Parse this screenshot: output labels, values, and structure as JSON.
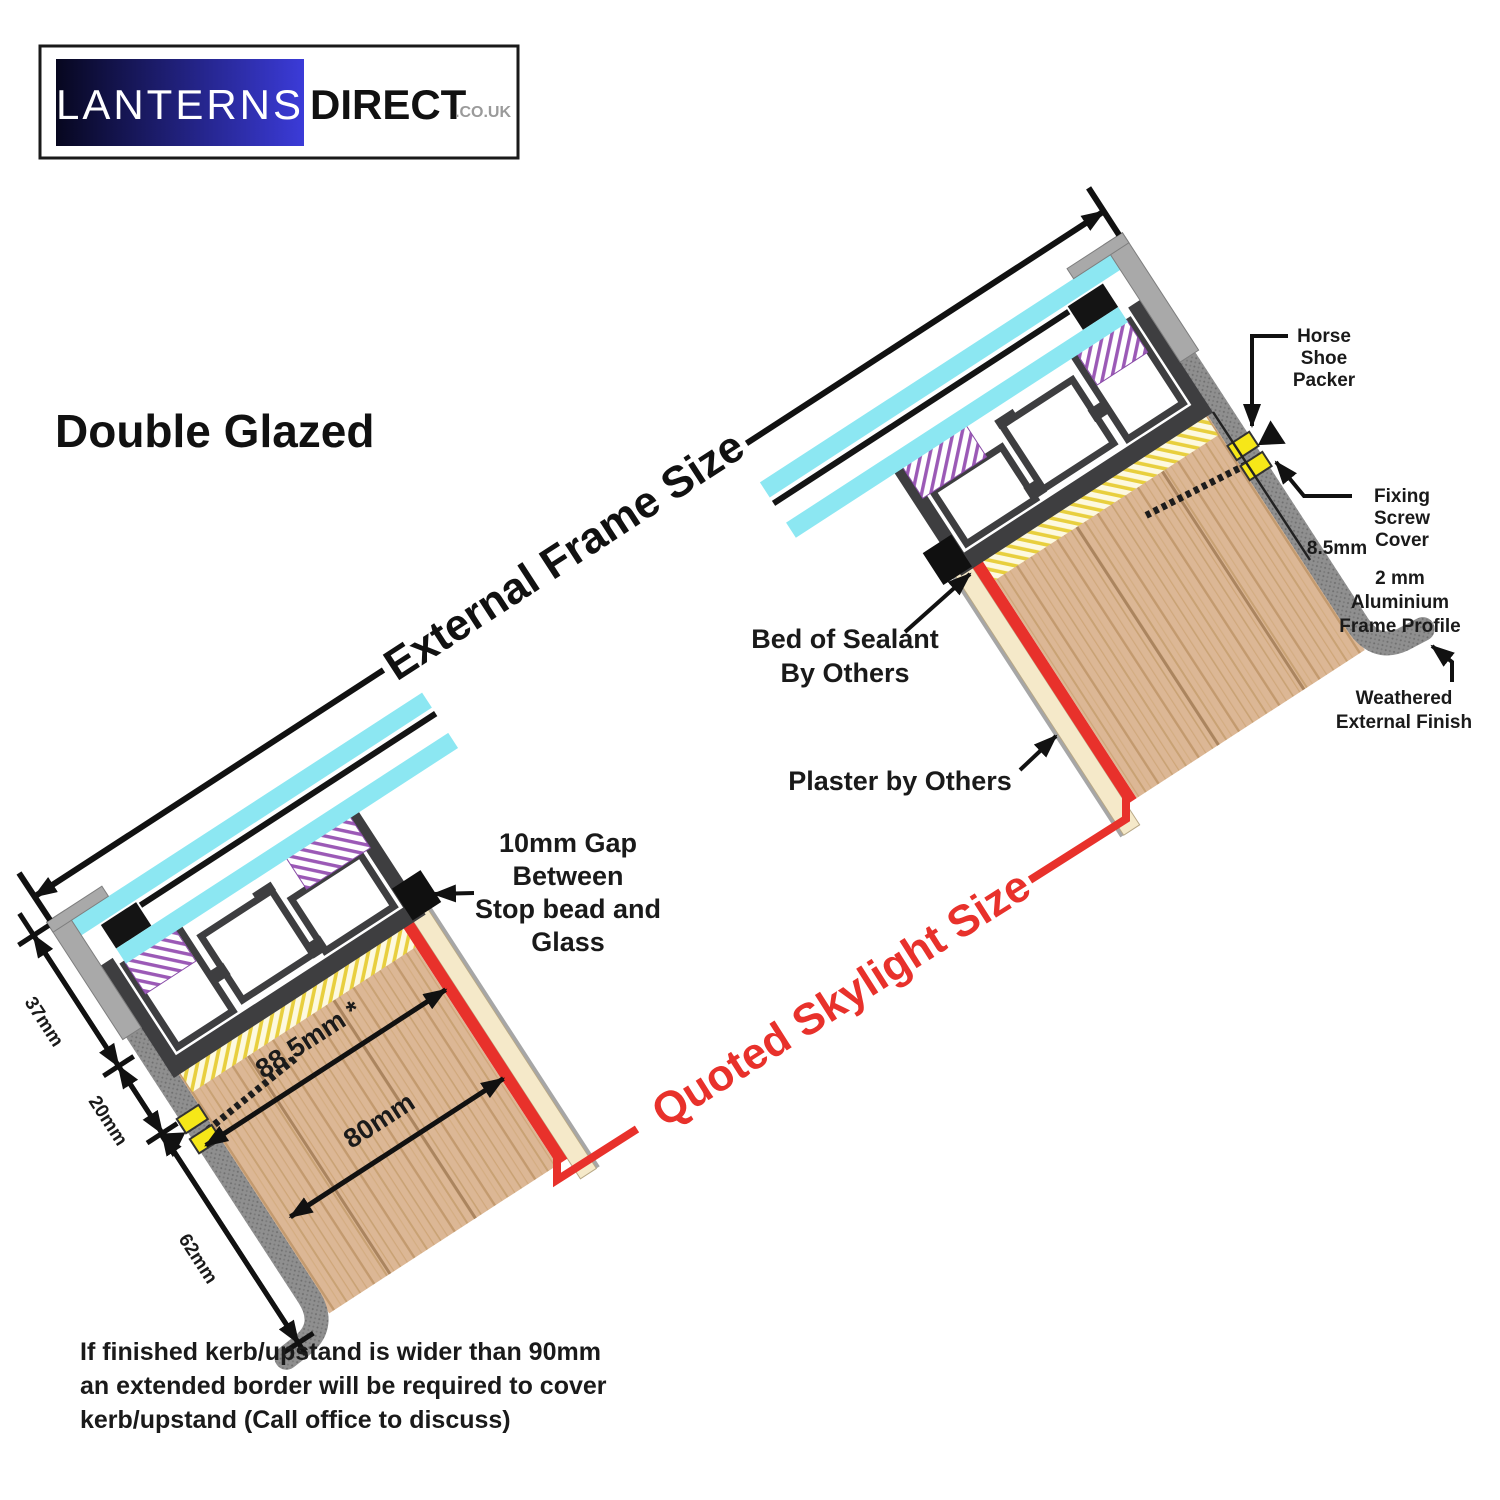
{
  "logo": {
    "brand_primary": "LANTERNS",
    "brand_secondary": "DIRECT",
    "brand_tld": ".CO.UK"
  },
  "heading": {
    "title": "Double Glazed"
  },
  "dimensions": {
    "external_frame": "External Frame Size",
    "quoted_skylight": "Quoted Skylight Size",
    "depth_37": "37mm",
    "depth_20": "20mm",
    "depth_62": "62mm",
    "kerb_top_width": "88.5mm *",
    "kerb_width": "80mm",
    "profile_gap": "8.5mm"
  },
  "callouts": {
    "horse_shoe_packer": [
      "Horse",
      "Shoe",
      "Packer"
    ],
    "fixing_screw_cover": [
      "Fixing",
      "Screw",
      "Cover"
    ],
    "aluminium_profile": [
      "2 mm",
      "Aluminium",
      "Frame Profile"
    ],
    "weathered_finish": [
      "Weathered",
      "External Finish"
    ],
    "bed_of_sealant": [
      "Bed of Sealant",
      "By Others"
    ],
    "plaster": "Plaster by Others",
    "gap_10mm": [
      "10mm Gap",
      "Between",
      "Stop bead and",
      "Glass"
    ]
  },
  "footnote": {
    "lines": [
      "If finished kerb/upstand is wider than 90mm",
      "an extended border will be required to cover",
      "kerb/upstand (Call office to discuss)"
    ]
  },
  "colors": {
    "accent_red": "#e8312b",
    "glass_cyan": "#8ce7f2",
    "wood_tan": "#dcb795",
    "packer_yellow": "#f6e718",
    "frame_gray": "#3e3e40",
    "weathered_gray": "#8f8f8f",
    "sealant_yellow": "#e8cf3e",
    "gasket_purple": "#9b59b6",
    "logo_blue": "#3838d6"
  }
}
